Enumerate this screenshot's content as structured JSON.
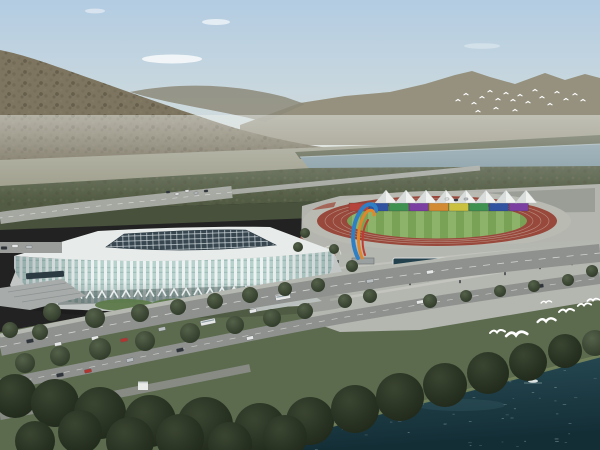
{
  "scene_label": "aerial-render-stadium-riverfront-park",
  "colors": {
    "sky-top": "#b3cce2",
    "sky-mid": "#cfdbdd",
    "sky-horizon": "#e0e3da",
    "cloud": "#ffffff",
    "far-mountain": "#95917e",
    "far-mountain-2": "#8d897a",
    "hill": "#7d7560",
    "hill-dark": "#56503c",
    "valley": "#9b9a87",
    "lake": "#8199a4",
    "lake-edge": "#aebfc6",
    "treeline": "#565c45",
    "band-mid": "#525c44",
    "band-dark": "#47513c",
    "grass": "#5c6a4e",
    "lawn": "#5d7a4b",
    "road": "#8e918d",
    "road-light": "#b5b8b1",
    "path-light": "#c6c8c1",
    "pavement": "#b3b5ae",
    "plaza": "#b4b6b0",
    "parking": "#9b9e97",
    "stadium-white": "#eef2f2",
    "glass": "#b7d2cc",
    "glass-dark": "#8fb0ac",
    "roof-white": "#e7ebea",
    "roof-dark": "#37464f",
    "roof-grid": "#cfd9dc",
    "arch-back": "#3c4a48",
    "track-red": "#99493c",
    "lane-line": "#cabcad",
    "field-green": "#79a257",
    "field-stripe": "#8db26a",
    "tent-white": "#f0f2f0",
    "tent-shade": "#d2d7d6",
    "flower-red": "#9e4a3a",
    "pool": "#23414d",
    "sculpture-blue": "#2f7fc4",
    "sculpture-orange": "#e0862c",
    "sculpture-red": "#c03c30",
    "water-top": "#2a4e58",
    "water-deep": "#142e36",
    "water-sparkle": "#cfe0e2",
    "bird": "#ffffff",
    "person": "#2e3338",
    "car-white": "#e6e8e7",
    "car-dark": "#2e343a",
    "car-red": "#b23530",
    "car-silver": "#b9bec0",
    "canopy-dark": "#2c3a42",
    "ramp": "#a7acab",
    "stair": "#bac0bd"
  },
  "track": {
    "seat_sections": [
      "#b5443c",
      "#31529f",
      "#3f9150",
      "#7a3fa0",
      "#d28a33",
      "#c9c13f",
      "#3f9150",
      "#31529f",
      "#7a3fa0"
    ],
    "sections_x0": 349,
    "sections_w": 20,
    "sections_y": 203,
    "sections_h": 8
  },
  "tents": {
    "count": 8,
    "start_x": 386,
    "step": 20,
    "peak_y": 190,
    "base_y": 203,
    "half_w": 11
  },
  "arches": {
    "x0": 62,
    "y0": 299,
    "n": 20,
    "dx": 12,
    "dy": -0.35
  },
  "parking": {
    "rows": [
      [
        420,
        199,
        12
      ],
      [
        424,
        207,
        12
      ]
    ],
    "step": 7.4,
    "car_w": 4.6,
    "car_h": 3.2
  },
  "sparkles": {
    "count": 48
  },
  "vehicles": {
    "palette": [
      "car-white",
      "car-dark",
      "car-red",
      "car-silver"
    ],
    "cars": [
      [
        30,
        341,
        -11,
        7,
        3.5,
        1
      ],
      [
        58,
        344,
        -11,
        7,
        3.5,
        0
      ],
      [
        95,
        338,
        -11,
        7,
        3.5,
        0
      ],
      [
        124,
        340,
        -11,
        7,
        3.5,
        2
      ],
      [
        162,
        329,
        -12,
        7,
        3.5,
        3
      ],
      [
        208,
        322,
        -12,
        15,
        5,
        0
      ],
      [
        253,
        311,
        -12,
        7,
        3.5,
        0
      ],
      [
        283,
        297,
        -10,
        15,
        5,
        0
      ],
      [
        370,
        281,
        -8,
        7,
        3.5,
        3
      ],
      [
        430,
        272,
        -8,
        7,
        3.5,
        0
      ],
      [
        7,
        383,
        -11,
        7,
        3.5,
        0
      ],
      [
        60,
        375,
        -11,
        7,
        3.5,
        1
      ],
      [
        88,
        371,
        -12,
        7,
        3.5,
        2
      ],
      [
        130,
        360,
        -12,
        7,
        3.5,
        3
      ],
      [
        180,
        350,
        -12,
        7,
        3.5,
        1
      ],
      [
        250,
        338,
        -12,
        7,
        3.5,
        0
      ],
      [
        420,
        302,
        -9,
        7,
        3.5,
        0
      ],
      [
        465,
        295,
        -9,
        7,
        3.5,
        3
      ],
      [
        540,
        286,
        -8,
        7,
        3.5,
        1
      ],
      [
        4,
        248,
        0,
        6,
        3,
        1
      ],
      [
        15,
        246,
        0,
        6,
        3,
        0
      ],
      [
        29,
        247,
        0,
        6,
        3,
        3
      ],
      [
        168,
        192,
        -5,
        4,
        2.2,
        1
      ],
      [
        177,
        194,
        -5,
        4,
        2.2,
        0
      ],
      [
        187,
        191,
        -5,
        4,
        2.2,
        0
      ],
      [
        196,
        193,
        -5,
        4,
        2.2,
        3
      ],
      [
        206,
        191,
        -5,
        4,
        2.2,
        1
      ],
      [
        447,
        199,
        -3,
        4,
        2.2,
        0
      ],
      [
        456,
        200,
        -3,
        4,
        2.2,
        1
      ],
      [
        466,
        199,
        -3,
        4,
        2.2,
        3
      ]
    ]
  },
  "trees": [
    [
      52,
      312,
      9
    ],
    [
      95,
      318,
      10
    ],
    [
      140,
      313,
      9
    ],
    [
      178,
      307,
      8
    ],
    [
      215,
      301,
      8
    ],
    [
      250,
      295,
      8
    ],
    [
      285,
      289,
      7
    ],
    [
      318,
      285,
      7
    ],
    [
      25,
      363,
      10
    ],
    [
      60,
      356,
      10
    ],
    [
      100,
      349,
      11
    ],
    [
      145,
      341,
      10
    ],
    [
      190,
      333,
      10
    ],
    [
      235,
      325,
      9
    ],
    [
      272,
      318,
      9
    ],
    [
      305,
      311,
      8
    ],
    [
      345,
      301,
      7
    ],
    [
      370,
      296,
      7
    ],
    [
      430,
      301,
      7
    ],
    [
      466,
      296,
      6
    ],
    [
      500,
      291,
      6
    ],
    [
      534,
      286,
      6
    ],
    [
      568,
      280,
      6
    ],
    [
      352,
      266,
      6
    ],
    [
      334,
      249,
      5
    ],
    [
      592,
      271,
      6
    ],
    [
      305,
      233,
      5
    ],
    [
      298,
      247,
      5
    ],
    [
      10,
      330,
      8
    ],
    [
      40,
      332,
      8
    ],
    [
      15,
      396,
      22
    ],
    [
      55,
      403,
      24
    ],
    [
      100,
      413,
      26
    ],
    [
      150,
      421,
      26
    ],
    [
      205,
      425,
      28
    ],
    [
      260,
      429,
      26
    ],
    [
      310,
      421,
      24
    ],
    [
      355,
      409,
      24
    ],
    [
      400,
      397,
      24
    ],
    [
      445,
      385,
      22
    ],
    [
      488,
      373,
      21
    ],
    [
      528,
      362,
      19
    ],
    [
      565,
      351,
      17
    ],
    [
      595,
      343,
      13
    ],
    [
      35,
      441,
      20
    ],
    [
      130,
      441,
      24
    ],
    [
      230,
      444,
      22
    ],
    [
      80,
      432,
      22
    ],
    [
      180,
      438,
      24
    ],
    [
      285,
      437,
      22
    ]
  ],
  "people": [
    [
      348,
      268
    ],
    [
      360,
      274
    ],
    [
      372,
      280
    ],
    [
      395,
      279
    ],
    [
      410,
      285
    ],
    [
      428,
      281
    ],
    [
      445,
      277
    ],
    [
      460,
      283
    ],
    [
      476,
      271
    ],
    [
      492,
      267
    ],
    [
      505,
      275
    ],
    [
      520,
      263
    ],
    [
      540,
      269
    ],
    [
      300,
      291
    ],
    [
      286,
      297
    ],
    [
      268,
      301
    ],
    [
      322,
      256
    ],
    [
      338,
      263
    ],
    [
      556,
      259
    ],
    [
      572,
      265
    ],
    [
      250,
      299
    ],
    [
      232,
      303
    ]
  ],
  "birds": {
    "far_flock": [
      [
        458,
        100
      ],
      [
        466,
        94
      ],
      [
        474,
        103
      ],
      [
        482,
        97
      ],
      [
        490,
        91
      ],
      [
        498,
        99
      ],
      [
        506,
        93
      ],
      [
        513,
        100
      ],
      [
        520,
        95
      ],
      [
        528,
        102
      ],
      [
        535,
        90
      ],
      [
        542,
        97
      ],
      [
        550,
        104
      ],
      [
        557,
        92
      ],
      [
        566,
        99
      ],
      [
        575,
        94
      ],
      [
        583,
        100
      ],
      [
        478,
        111
      ],
      [
        496,
        108
      ],
      [
        515,
        110
      ]
    ],
    "gulls": [
      [
        497,
        333,
        1.0
      ],
      [
        516,
        336,
        1.4
      ],
      [
        546,
        322,
        1.2
      ],
      [
        566,
        312,
        1.0
      ],
      [
        584,
        306,
        0.9
      ],
      [
        546,
        303,
        0.7
      ],
      [
        593,
        301,
        0.8
      ]
    ]
  }
}
